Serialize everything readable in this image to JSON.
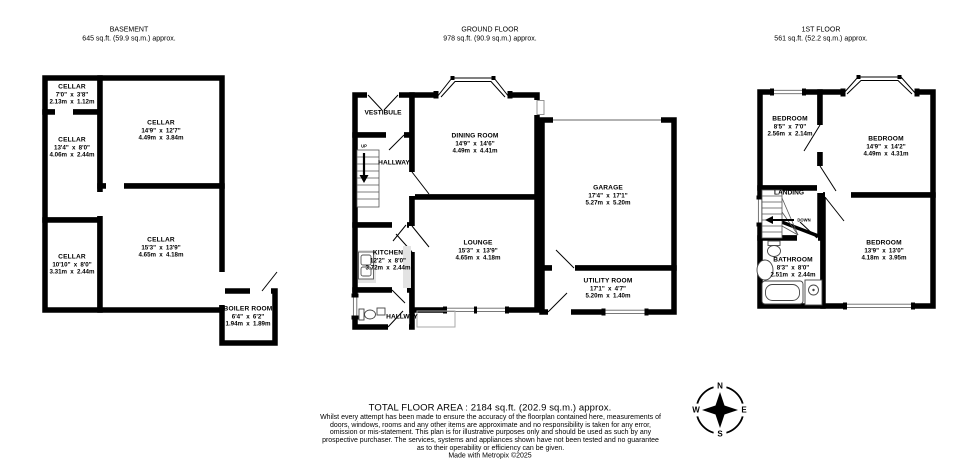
{
  "basement": {
    "title": "BASEMENT",
    "area": "645 sq.ft. (59.9 sq.m.) approx.",
    "rooms": {
      "cellar1": {
        "name": "CELLAR",
        "dims": "7'0\" x 3'8\"",
        "metric": "2.13m x 1.12m"
      },
      "cellar2": {
        "name": "CELLAR",
        "dims": "14'9\" x 12'7\"",
        "metric": "4.49m x 3.84m"
      },
      "cellar3": {
        "name": "CELLAR",
        "dims": "13'4\" x 8'0\"",
        "metric": "4.06m x 2.44m"
      },
      "cellar4": {
        "name": "CELLAR",
        "dims": "10'10\" x 8'0\"",
        "metric": "3.31m x 2.44m"
      },
      "cellar5": {
        "name": "CELLAR",
        "dims": "15'3\" x 13'9\"",
        "metric": "4.65m x 4.18m"
      },
      "boiler": {
        "name": "BOILER ROOM",
        "dims": "6'4\" x 6'2\"",
        "metric": "1.94m x 1.89m"
      }
    }
  },
  "ground": {
    "title": "GROUND FLOOR",
    "area": "978 sq.ft. (90.9 sq.m.) approx.",
    "rooms": {
      "vestibule": {
        "name": "VESTIBULE"
      },
      "hallway": {
        "name": "HALLWAY"
      },
      "hallway2": {
        "name": "HALLWAY"
      },
      "up": "UP",
      "dining": {
        "name": "DINING ROOM",
        "dims": "14'9\" x 14'6\"",
        "metric": "4.49m x 4.41m"
      },
      "garage": {
        "name": "GARAGE",
        "dims": "17'4\" x 17'1\"",
        "metric": "5.27m x 5.20m"
      },
      "kitchen": {
        "name": "KITCHEN",
        "dims": "12'2\" x 8'0\"",
        "metric": "3.72m x 2.44m"
      },
      "lounge": {
        "name": "LOUNGE",
        "dims": "15'3\" x 13'9\"",
        "metric": "4.65m x 4.18m"
      },
      "utility": {
        "name": "UTILITY ROOM",
        "dims": "17'1\" x 4'7\"",
        "metric": "5.20m x 1.40m"
      }
    }
  },
  "first": {
    "title": "1ST FLOOR",
    "area": "561 sq.ft. (52.2 sq.m.) approx.",
    "rooms": {
      "bedroom1": {
        "name": "BEDROOM",
        "dims": "8'5\" x 7'0\"",
        "metric": "2.56m x 2.14m"
      },
      "bedroom2": {
        "name": "BEDROOM",
        "dims": "14'9\" x 14'2\"",
        "metric": "4.49m x 4.31m"
      },
      "bedroom3": {
        "name": "BEDROOM",
        "dims": "13'9\" x 13'0\"",
        "metric": "4.18m x 3.95m"
      },
      "bathroom": {
        "name": "BATHROOM",
        "dims": "8'3\" x 8'0\"",
        "metric": "2.51m x 2.44m"
      },
      "landing": {
        "name": "LANDING"
      },
      "down": "DOWN"
    }
  },
  "compass": {
    "n": "N",
    "e": "E",
    "s": "S",
    "w": "W"
  },
  "footer": {
    "total": "TOTAL FLOOR AREA : 2184 sq.ft. (202.9 sq.m.) approx.",
    "disclaimer": "Whilst every attempt has been made to ensure the accuracy of the floorplan contained here, measurements of doors, windows, rooms and any other items are approximate and no responsibility is taken for any error, omission or mis-statement. This plan is for illustrative purposes only and should be used as such by any prospective purchaser. The services, systems and appliances shown have not been tested and no guarantee as to their operability or efficiency can be given.",
    "credit": "Made with Metropix ©2025"
  }
}
